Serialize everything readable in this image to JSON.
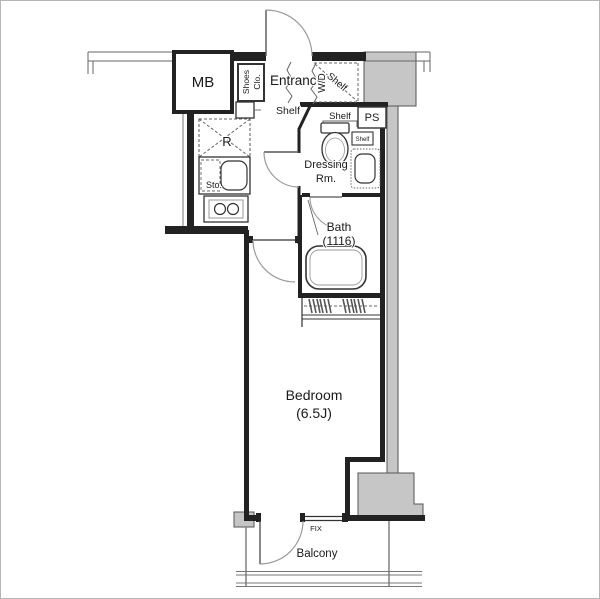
{
  "floorplan": {
    "colors": {
      "wall": "#222222",
      "gray": "#c6c6c6",
      "grayline": "#555555",
      "line": "#666666",
      "arc": "#9a9a9a",
      "text": "#1a1a1a"
    },
    "labels": {
      "mb": "MB",
      "shoes_line1": "Shoes",
      "shoes_line2": "Clo.",
      "entrance": "Entrance",
      "entrance_shelf": "Shelf",
      "wd": "W/D",
      "wd_shelf": "Shelf",
      "ps": "PS",
      "toilet_shelf": "Shelf",
      "side_shelf": "Shelf",
      "dressing1": "Dressing",
      "dressing2": "Rm.",
      "bath": "Bath",
      "bath_size": "(1116)",
      "fridge": "R",
      "storage": "Sto.",
      "bedroom": "Bedroom",
      "bedroom_size": "(6.5J)",
      "fix": "FIX",
      "balcony": "Balcony"
    }
  }
}
